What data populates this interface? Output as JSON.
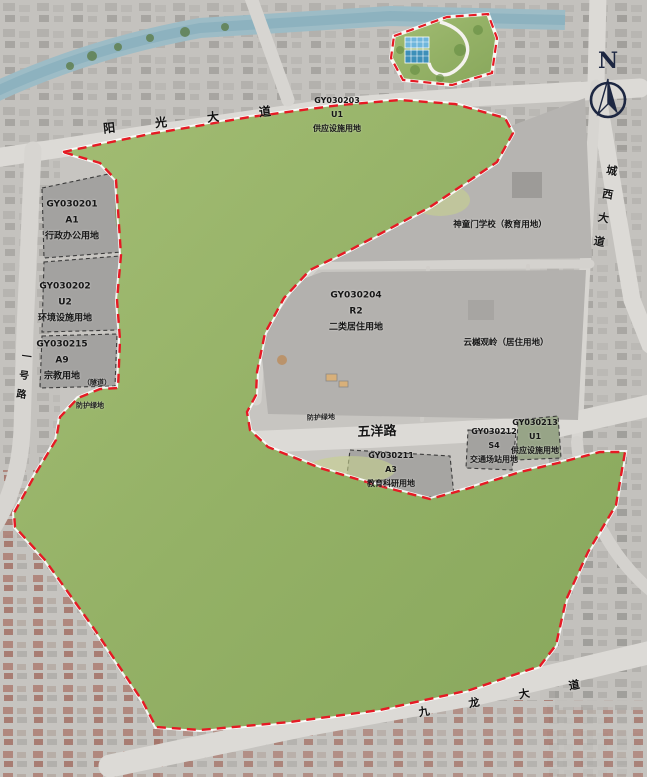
{
  "map": {
    "north_label": "N",
    "roads": [
      {
        "name": "yangguang-avenue",
        "label": "阳 光 大 道"
      },
      {
        "name": "chengxi-avenue",
        "label": "城西大道"
      },
      {
        "name": "wuyang-road",
        "label": "五洋路"
      },
      {
        "name": "jiulong-avenue",
        "label": "九 龙 大 道"
      },
      {
        "name": "yihao-road",
        "label": "一号路"
      }
    ],
    "parcels": [
      {
        "id": "GY030201",
        "code": "A1",
        "use": "行政办公用地"
      },
      {
        "id": "GY030202",
        "code": "U2",
        "use": "环境设施用地"
      },
      {
        "id": "GY030215",
        "code": "A9",
        "use": "宗教用地"
      },
      {
        "id": "GY030203",
        "code": "U1",
        "use": "供应设施用地"
      },
      {
        "id": "GY030204",
        "code": "R2",
        "use": "二类居住用地"
      },
      {
        "id": "GY030211",
        "code": "A3",
        "use": "教育科研用地"
      },
      {
        "id": "GY030212",
        "code": "S4",
        "use": "交通场站用地"
      },
      {
        "id": "GY030213",
        "code": "U1",
        "use": "供应设施用地"
      }
    ],
    "annotations": [
      {
        "name": "school",
        "label": "神童门学校（教育用地）"
      },
      {
        "name": "residence",
        "label": "云樾观岭（居住用地）"
      },
      {
        "name": "tunnel",
        "label": "（隧道）"
      },
      {
        "name": "buffer-green-west",
        "label": "防护绿地"
      },
      {
        "name": "buffer-green-road",
        "label": "防护绿地"
      }
    ],
    "colors": {
      "boundary_red": "#e51a24",
      "park_green": "#9cb96e",
      "water_blue": "#8ccede",
      "road_grey": "#d9d7d3",
      "parcel_grey": "#a3a2a0"
    }
  }
}
